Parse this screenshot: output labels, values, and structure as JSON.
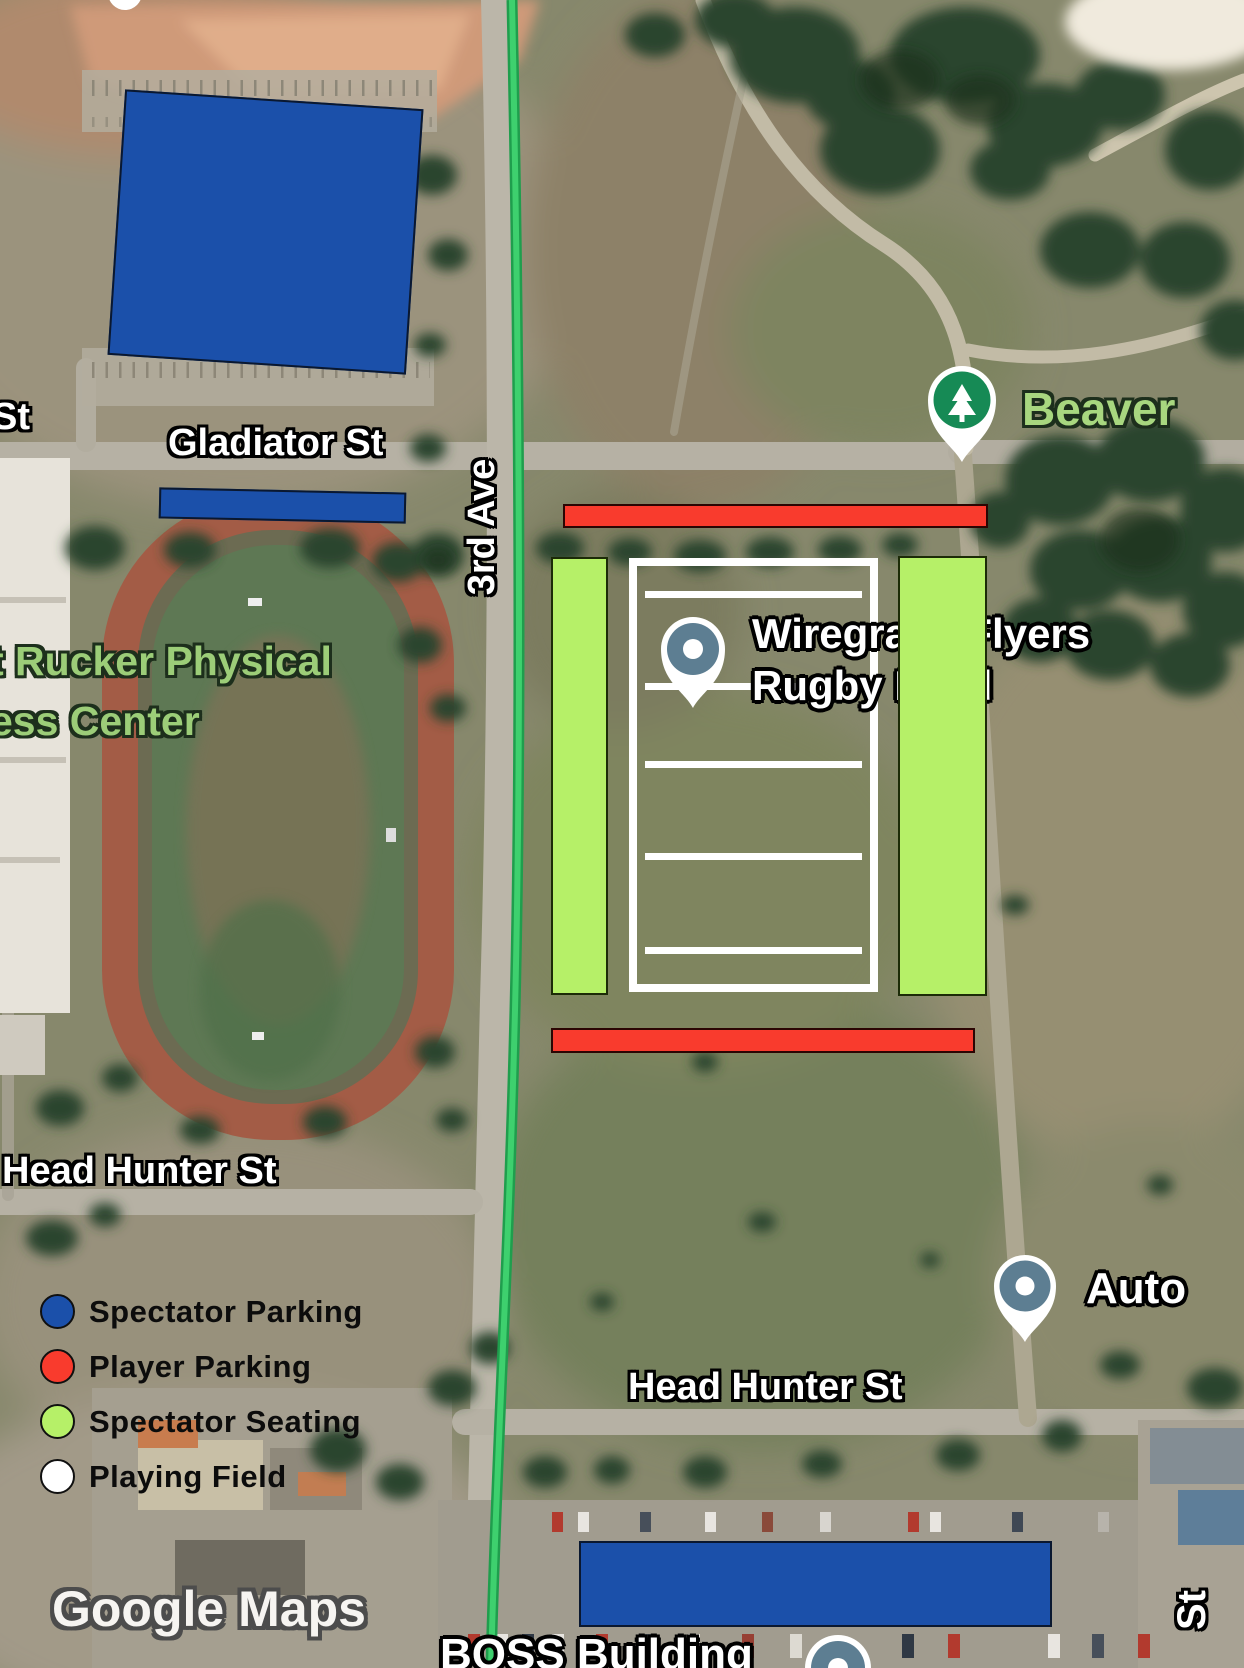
{
  "watermark": "Google Maps",
  "streets": {
    "left_partial": "St",
    "gladiator": "Gladiator St",
    "third_ave": "3rd Ave",
    "head_hunter_west": "Head Hunter St",
    "head_hunter_east": "Head Hunter St",
    "right_partial": "St"
  },
  "places": {
    "fitness_center_line1": "t Rucker Physical",
    "fitness_center_line2": "ess Center"
  },
  "pins": {
    "rugby": {
      "label_line1": "Wiregrass Flyers",
      "label_line2": "Rugby Field",
      "color": "#5d7e92"
    },
    "beaver": {
      "label": "Beaver",
      "color": "#168a55"
    },
    "auto": {
      "label": "Auto",
      "color": "#5d7e92"
    },
    "boss": {
      "label": "BOSS Building",
      "color": "#5d7e92"
    }
  },
  "legend": {
    "items": [
      {
        "label": "Spectator Parking",
        "color": "#1b50aa"
      },
      {
        "label": "Player Parking",
        "color": "#f93b2d"
      },
      {
        "label": "Spectator Seating",
        "color": "#b6f068"
      },
      {
        "label": "Playing Field",
        "color": "#ffffff"
      }
    ]
  },
  "overlays": {
    "spectator_parking_color": "#1b50aa",
    "player_parking_color": "#f93b2d",
    "spectator_seating_color": "#b6f068",
    "playing_field_color": "#ffffff",
    "route_color": "#3ed06e"
  }
}
